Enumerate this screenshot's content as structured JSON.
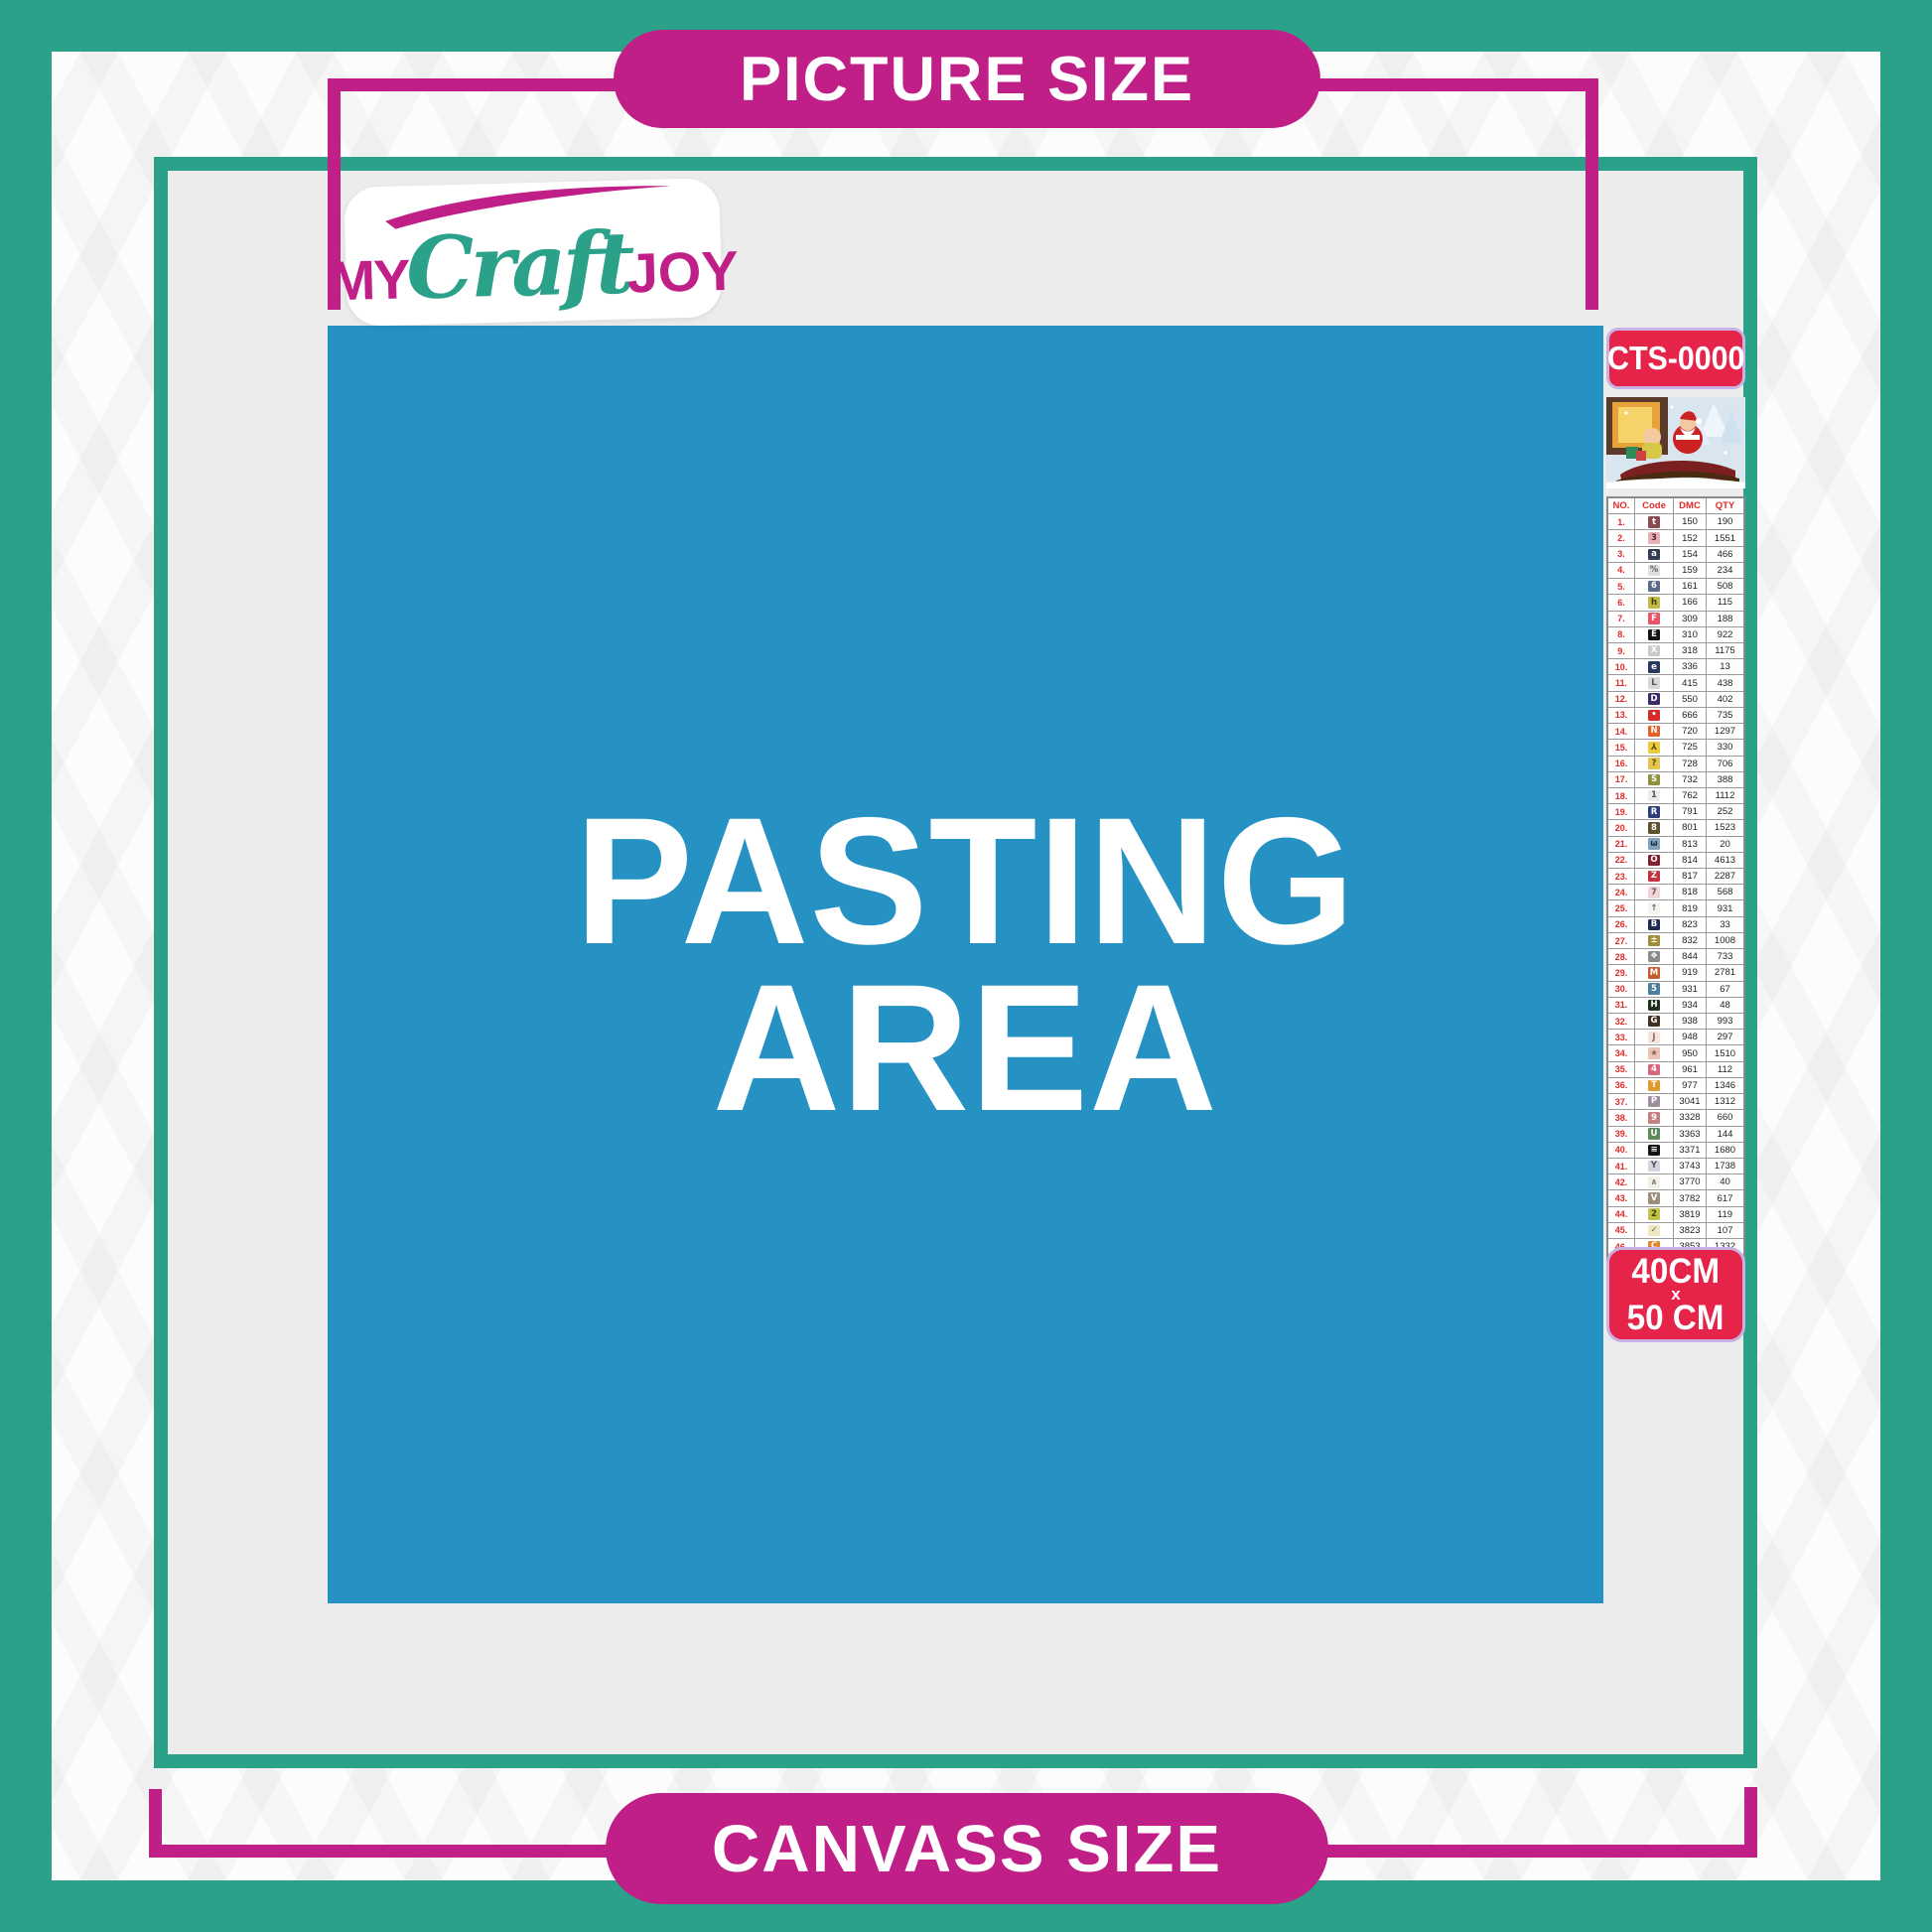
{
  "banners": {
    "top": "PICTURE SIZE",
    "bottom": "CANVASS SIZE"
  },
  "logo": {
    "part1": "MY",
    "part2": "Craft",
    "part3": "JOY"
  },
  "pasting_area": {
    "line1": "PASTING",
    "line2": "AREA"
  },
  "product": {
    "code": "CTS-0000",
    "size_line1": "40CM",
    "size_line2": "x",
    "size_line3": "50 CM",
    "thumbnail": "santa-sleigh-christmas-scene"
  },
  "colors": {
    "teal": "#2CA189",
    "magenta": "#C01F87",
    "blue": "#2592C3",
    "crimson": "#E62349",
    "lavender_border": "#C6B3E3",
    "table_red": "#E02A2A",
    "panel_gray": "#ECECEC"
  },
  "table": {
    "headers": [
      "NO.",
      "Code",
      "DMC",
      "QTY"
    ],
    "rows": [
      [
        "1.",
        "t",
        "#8A4A52",
        "#ffffff",
        "150",
        "190"
      ],
      [
        "2.",
        "3",
        "#E7AFB8",
        "#5a2a33",
        "152",
        "1551"
      ],
      [
        "3.",
        "a",
        "#333A52",
        "#ffffff",
        "154",
        "466"
      ],
      [
        "4.",
        "%",
        "#DFDFDF",
        "#666666",
        "159",
        "234"
      ],
      [
        "5.",
        "6",
        "#5A6A89",
        "#ffffff",
        "161",
        "508"
      ],
      [
        "6.",
        "h",
        "#C0B945",
        "#3d3a0a",
        "166",
        "115"
      ],
      [
        "7.",
        "F",
        "#E85566",
        "#ffffff",
        "309",
        "188"
      ],
      [
        "8.",
        "E",
        "#141414",
        "#ffffff",
        "310",
        "922"
      ],
      [
        "9.",
        "X",
        "#C9C9C9",
        "#ffffff",
        "318",
        "1175"
      ],
      [
        "10.",
        "e",
        "#2A3A5E",
        "#ffffff",
        "336",
        "13"
      ],
      [
        "11.",
        "L",
        "#D8D8D8",
        "#555555",
        "415",
        "438"
      ],
      [
        "12.",
        "D",
        "#3D2A66",
        "#ffffff",
        "550",
        "402"
      ],
      [
        "13.",
        "•",
        "#D42B2B",
        "#ffffff",
        "666",
        "735"
      ],
      [
        "14.",
        "N",
        "#E2622A",
        "#ffffff",
        "720",
        "1297"
      ],
      [
        "15.",
        "⅄",
        "#EDC93E",
        "#5a4a10",
        "725",
        "330"
      ],
      [
        "16.",
        "?",
        "#E3C44E",
        "#5a4a10",
        "728",
        "706"
      ],
      [
        "17.",
        "S",
        "#8F8F3E",
        "#ffffff",
        "732",
        "388"
      ],
      [
        "18.",
        "1",
        "#ECECEC",
        "#555555",
        "762",
        "1112"
      ],
      [
        "19.",
        "R",
        "#2E3D78",
        "#ffffff",
        "791",
        "252"
      ],
      [
        "20.",
        "8",
        "#5F5030",
        "#ffffff",
        "801",
        "1523"
      ],
      [
        "21.",
        "ω",
        "#7FA3BD",
        "#1d2d3d",
        "813",
        "20"
      ],
      [
        "22.",
        "O",
        "#7E2230",
        "#ffffff",
        "814",
        "4613"
      ],
      [
        "23.",
        "Z",
        "#C23240",
        "#ffffff",
        "817",
        "2287"
      ],
      [
        "24.",
        "7",
        "#F2D5D8",
        "#7a5a5e",
        "818",
        "568"
      ],
      [
        "25.",
        "↑",
        "#F6F4EE",
        "#666666",
        "819",
        "931"
      ],
      [
        "26.",
        "B",
        "#1D2B50",
        "#ffffff",
        "823",
        "33"
      ],
      [
        "27.",
        "±",
        "#A38C3A",
        "#ffffff",
        "832",
        "1008"
      ],
      [
        "28.",
        "❖",
        "#8B8B8B",
        "#ffffff",
        "844",
        "733"
      ],
      [
        "29.",
        "M",
        "#C05C2E",
        "#ffffff",
        "919",
        "2781"
      ],
      [
        "30.",
        "5",
        "#4F7E98",
        "#ffffff",
        "931",
        "67"
      ],
      [
        "31.",
        "H",
        "#22301F",
        "#ffffff",
        "934",
        "48"
      ],
      [
        "32.",
        "G",
        "#40301F",
        "#ffffff",
        "938",
        "993"
      ],
      [
        "33.",
        "J",
        "#F6E3DE",
        "#8a6a62",
        "948",
        "297"
      ],
      [
        "34.",
        "★",
        "#E9C3B6",
        "#8a6a5e",
        "950",
        "1510"
      ],
      [
        "35.",
        "4",
        "#D4697E",
        "#ffffff",
        "961",
        "112"
      ],
      [
        "36.",
        "T",
        "#E2992F",
        "#ffffff",
        "977",
        "1346"
      ],
      [
        "37.",
        "P",
        "#9D8F9D",
        "#ffffff",
        "3041",
        "1312"
      ],
      [
        "38.",
        "9",
        "#C37F82",
        "#ffffff",
        "3328",
        "660"
      ],
      [
        "39.",
        "U",
        "#5D8A5D",
        "#ffffff",
        "3363",
        "144"
      ],
      [
        "40.",
        "≡",
        "#141414",
        "#ffffff",
        "3371",
        "1680"
      ],
      [
        "41.",
        "Y",
        "#D4D4DE",
        "#555555",
        "3743",
        "1738"
      ],
      [
        "42.",
        "∧",
        "#F4EFE4",
        "#777777",
        "3770",
        "40"
      ],
      [
        "43.",
        "V",
        "#9C8D7C",
        "#ffffff",
        "3782",
        "617"
      ],
      [
        "44.",
        "2",
        "#C3C24A",
        "#3d3d0a",
        "3819",
        "119"
      ],
      [
        "45.",
        "✓",
        "#EFE7C2",
        "#666666",
        "3823",
        "107"
      ],
      [
        "46.",
        "C",
        "#E2852D",
        "#ffffff",
        "3853",
        "1332"
      ],
      [
        "47.",
        "K",
        "#8B4A3C",
        "#ffffff",
        "3858",
        "2311"
      ],
      [
        "48.",
        "A",
        "#C0B2A5",
        "#443a30",
        "3863",
        "1820"
      ]
    ]
  }
}
